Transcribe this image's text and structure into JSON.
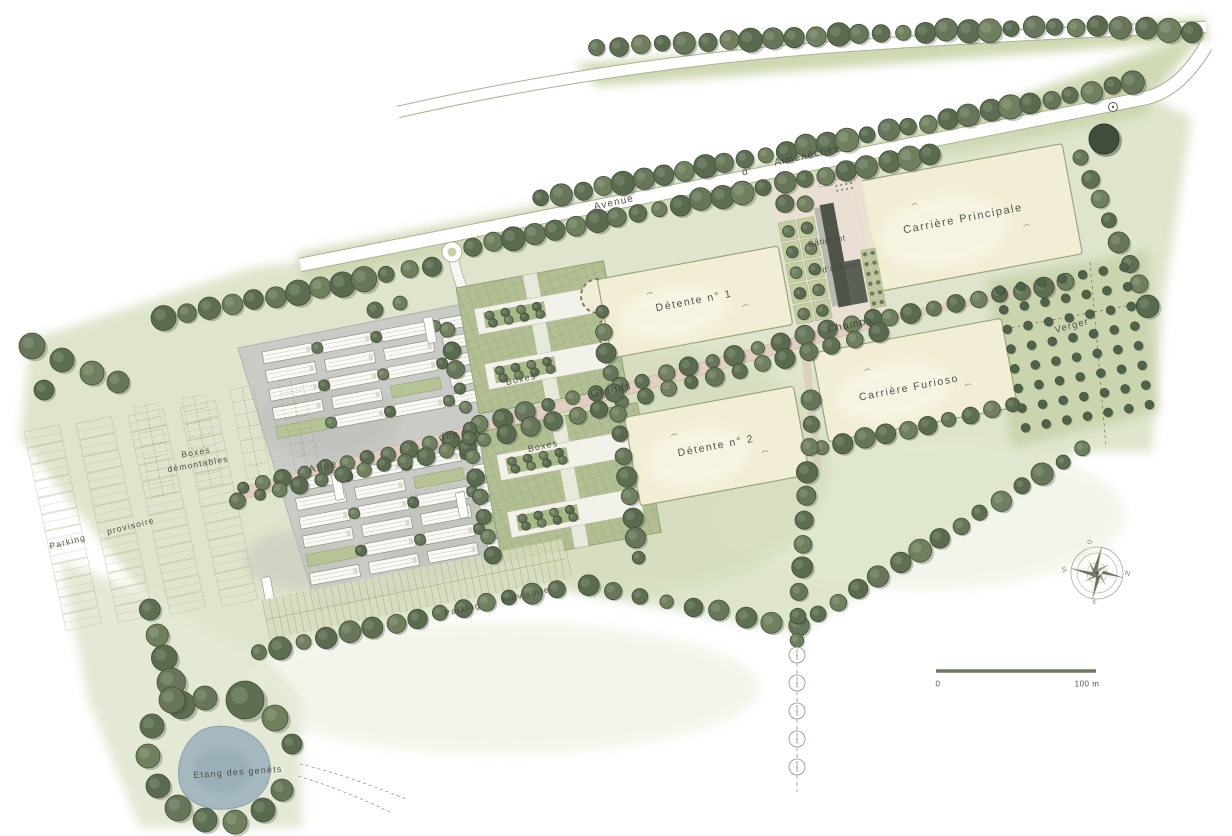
{
  "labels": {
    "avenue_1": "Avenue",
    "avenue_2": "d'",
    "avenue_3": "Almenêches",
    "allee_1": "Allée",
    "allee_2": "des",
    "allee_3": "Grands",
    "allee_4": "Champs",
    "carriere_principale": "Carrière Principale",
    "detente_1": "Détente n° 1",
    "detente_2": "Détente n° 2",
    "carriere_furioso": "Carrière Furioso",
    "verger": "Verger",
    "boxes_upper": "Boxes",
    "boxes_lower": "Boxes",
    "boxes_demontables_1": "Boxes",
    "boxes_demontables_2": "démontables",
    "parking_left_1": "Parking",
    "parking_left_2": "provisoire",
    "parking_bottom_1": "Parking",
    "parking_bottom_2": "provisoire",
    "batiment_1": "Bâtiment",
    "batiment_2": "d'accueil",
    "etang": "Etang des genêts"
  },
  "scale_bar": {
    "start": "0",
    "end": "100 m"
  },
  "compass": {
    "north": "N",
    "south": "S",
    "east": "E",
    "west": "O"
  },
  "colors": {
    "wash_green": "#dce3c8",
    "dark_green_band": "#cbd6ac",
    "tree_green": "#67765a",
    "arena_beige": "#f2eed5",
    "path_pink": "#e0cfc2",
    "paving_gray": "#c9ccc6",
    "pond_blue": "#a2b5be",
    "label_ink": "#45473e"
  }
}
